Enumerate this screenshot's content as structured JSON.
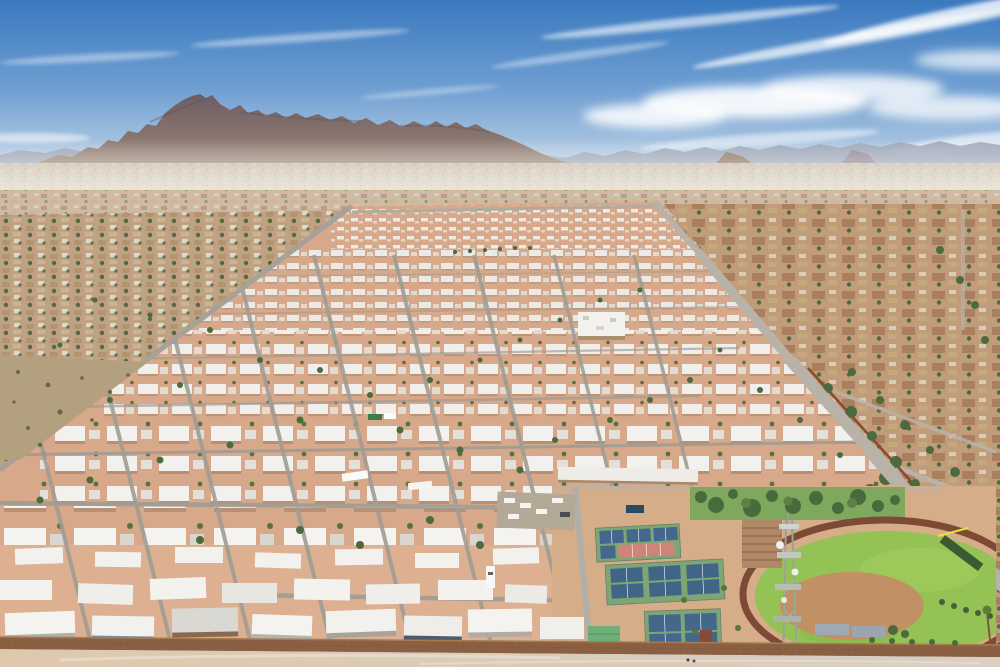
{
  "scene": {
    "type": "aerial-photograph",
    "description": "Drone aerial view of a large desert mobile home park community with a rugged mountain range on the horizon, dense suburban sprawl in the mid-distance, rows of white-roofed homes, pickleball courts, a green ballfield with dirt infield, a lattice cell tower and a brown perimeter wall in the foreground.",
    "landmarks": [
      "mountain range",
      "distant ridge line",
      "desert suburban sprawl",
      "mobile home park",
      "community building",
      "pickleball courts",
      "red courts",
      "green lawn with trees",
      "baseball field",
      "running track",
      "dugout shade structures",
      "cell tower",
      "perimeter wall",
      "main road",
      "rv parking"
    ]
  },
  "colors": {
    "sky_top": "#3a79bf",
    "sky_mid": "#6f9fd2",
    "sky_horizon": "#c9d9e9",
    "cloud_white": "#ffffff",
    "ridge_far": "#98a0b0",
    "mountain_top": "#6b5b63",
    "mountain_base": "#a38c79",
    "valley_base": "#c8bba7",
    "sprawl_base": "#bb9a79",
    "suburb_base": "#bfa183",
    "park_ground": "#d7a88a",
    "park_ground_near": "#ddb092",
    "roof_white": "#f2f1ed",
    "roof_shadow": "#c2bdb3",
    "street_gray": "#a09c94",
    "road_light": "#b9b2a8",
    "rust_wall": "#8a4a2e",
    "lawn_green": "#7fa85e",
    "field_green": "#94c254",
    "infield_tan": "#c29065",
    "track_brown": "#7c4a35",
    "court_green": "#7da674",
    "court_blue": "#44688c",
    "court_red": "#d08478",
    "tree_green": "#4c6a3e",
    "palm_green": "#5d7a3a",
    "shrub_olive": "#6b6648",
    "green_roof": "#6fae77",
    "dugout_gray": "#9fa9b4",
    "tower_gray": "#9aa39b",
    "wall_brown": "#8a5f42",
    "wall_top": "#a87a52",
    "fore_dirt": "#dfc9ad",
    "fore_road": "#d8cec2",
    "left_field": "#b2a07f",
    "nb_roof": "#a97f5e",
    "commercial_white": "#eae6de",
    "accent_blue": "#2b4a66"
  }
}
